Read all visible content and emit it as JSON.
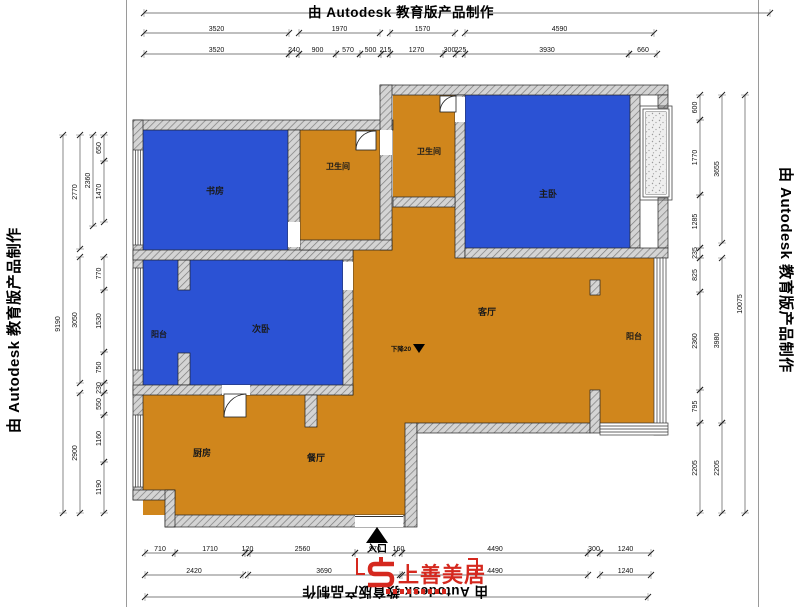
{
  "watermarks": {
    "top": "由 Autodesk 教育版产品制作",
    "left": "由 Autodesk 教育版产品制作",
    "right": "由 Autodesk 教育版产品制作",
    "bottom": "由 Autodesk 教育版产品制作"
  },
  "rooms": {
    "study": "书房",
    "bath_top": "卫生间",
    "bath_mid": "卫生间",
    "master": "主卧",
    "balcony_left": "阳台",
    "bedroom_second": "次卧",
    "living": "客厅",
    "balcony_right": "阳台",
    "kitchen": "厨房",
    "dining": "餐厅"
  },
  "annotations": {
    "entrance": "入口",
    "floor_drop": "下降20"
  },
  "logo": {
    "brand": "上善美居"
  },
  "colors": {
    "blue": "#2b52d4",
    "orange": "#d0861c",
    "red": "#d5281e"
  },
  "dims": [
    {
      "axis": "h",
      "line": 13,
      "segs": [
        [
          144,
          770,
          ""
        ]
      ]
    },
    {
      "axis": "h",
      "line": 33,
      "segs": [
        [
          144,
          289,
          "3520"
        ],
        [
          299,
          380,
          "1970"
        ],
        [
          390,
          455,
          "1570"
        ],
        [
          465,
          654,
          "4590"
        ]
      ]
    },
    {
      "axis": "h",
      "line": 54,
      "segs": [
        [
          144,
          289,
          "3520"
        ],
        [
          289,
          299,
          "240"
        ],
        [
          299,
          336,
          "900"
        ],
        [
          336,
          360,
          "570"
        ],
        [
          360,
          381,
          "500"
        ],
        [
          381,
          390,
          "215"
        ],
        [
          390,
          443,
          "1270"
        ],
        [
          443,
          456,
          "300"
        ],
        [
          456,
          465,
          "225"
        ],
        [
          465,
          629,
          "3930"
        ],
        [
          629,
          657,
          "660"
        ]
      ]
    },
    {
      "axis": "v",
      "line": 63,
      "segs": [
        [
          135,
          513,
          "9190"
        ]
      ]
    },
    {
      "axis": "v",
      "line": 80,
      "segs": [
        [
          135,
          249,
          "2770"
        ],
        [
          257,
          383,
          "3050"
        ],
        [
          393,
          513,
          "2900"
        ]
      ]
    },
    {
      "axis": "v",
      "line": 93,
      "segs": [
        [
          135,
          226,
          "2360"
        ]
      ]
    },
    {
      "axis": "v",
      "line": 104,
      "segs": [
        [
          135,
          161,
          "650"
        ],
        [
          161,
          222,
          "1470"
        ],
        [
          257,
          290,
          "770"
        ],
        [
          290,
          352,
          "1530"
        ],
        [
          352,
          383,
          "750"
        ],
        [
          383,
          393,
          "230"
        ],
        [
          393,
          415,
          "550"
        ],
        [
          415,
          462,
          "1160"
        ],
        [
          462,
          513,
          "1190"
        ]
      ]
    },
    {
      "axis": "v",
      "line": 700,
      "segs": [
        [
          95,
          120,
          "600"
        ],
        [
          120,
          195,
          "1770"
        ],
        [
          195,
          248,
          "1285"
        ],
        [
          248,
          258,
          "235"
        ],
        [
          258,
          292,
          "825"
        ],
        [
          292,
          390,
          "2360"
        ],
        [
          390,
          423,
          "795"
        ],
        [
          423,
          513,
          "2205"
        ]
      ]
    },
    {
      "axis": "v",
      "line": 722,
      "segs": [
        [
          95,
          243,
          "3655"
        ],
        [
          258,
          423,
          "3980"
        ],
        [
          423,
          513,
          "2205"
        ]
      ]
    },
    {
      "axis": "v",
      "line": 745,
      "segs": [
        [
          95,
          513,
          "10075"
        ]
      ]
    },
    {
      "axis": "h",
      "line": 553,
      "segs": [
        [
          145,
          175,
          "710"
        ],
        [
          175,
          245,
          "1710"
        ],
        [
          245,
          250,
          "120"
        ],
        [
          250,
          355,
          "2560"
        ],
        [
          355,
          395,
          "970"
        ],
        [
          395,
          402,
          "160"
        ],
        [
          402,
          588,
          "4490"
        ],
        [
          588,
          600,
          "300"
        ],
        [
          600,
          651,
          "1240"
        ]
      ]
    },
    {
      "axis": "h",
      "line": 575,
      "segs": [
        [
          145,
          243,
          "2420"
        ],
        [
          248,
          400,
          "3690"
        ],
        [
          402,
          588,
          "4490"
        ],
        [
          600,
          651,
          "1240"
        ]
      ]
    },
    {
      "axis": "h",
      "line": 597,
      "segs": [
        [
          145,
          648,
          ""
        ]
      ]
    }
  ]
}
